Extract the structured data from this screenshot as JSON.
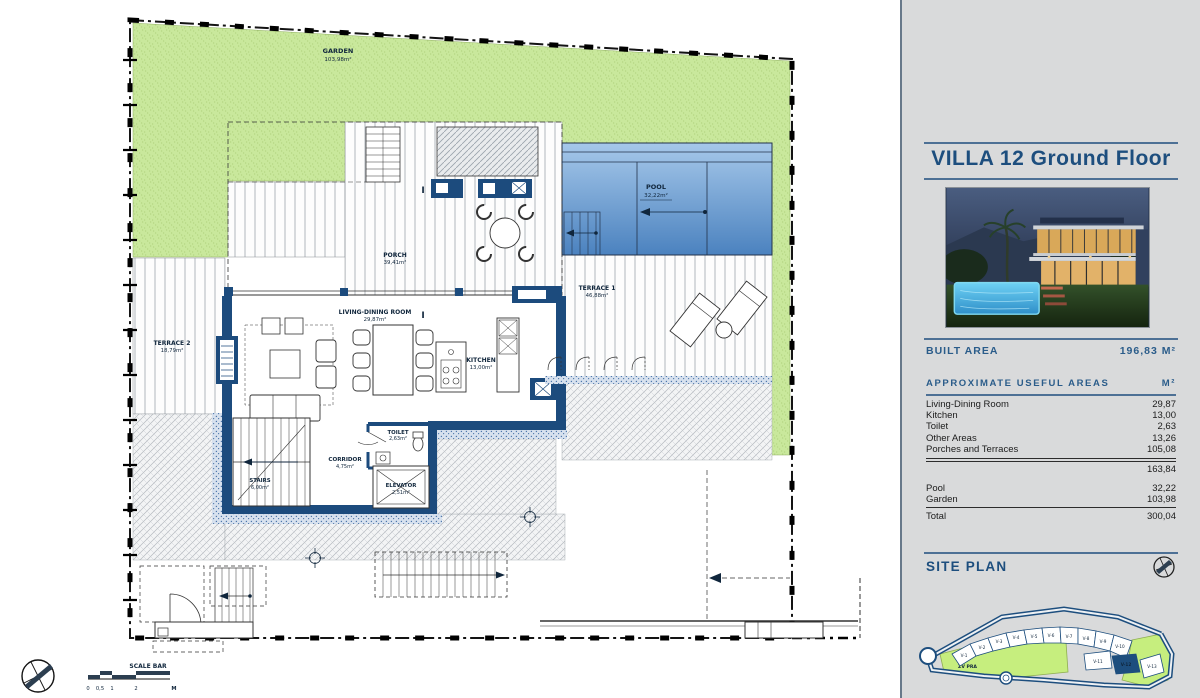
{
  "panel": {
    "title": "VILLA 12 Ground Floor",
    "built_area": {
      "label": "BUILT AREA",
      "value": "196,83 M²"
    },
    "areas": {
      "heading": "APPROXIMATE USEFUL AREAS",
      "unit": "M²",
      "rows": [
        {
          "label": "Living-Dining Room",
          "value": "29,87"
        },
        {
          "label": "Kitchen",
          "value": "13,00"
        },
        {
          "label": "Toilet",
          "value": "2,63"
        },
        {
          "label": "Other Areas",
          "value": "13,26"
        },
        {
          "label": "Porches and Terraces",
          "value": "105,08"
        }
      ],
      "subtotal": "163,84",
      "outdoor_rows": [
        {
          "label": "Pool",
          "value": "32,22"
        },
        {
          "label": "Garden",
          "value": "103,98"
        }
      ],
      "total_label": "Total",
      "total_value": "300,04"
    },
    "site_plan": {
      "heading": "SITE PLAN",
      "green_label": "ZV PRA",
      "plots": [
        "V-1",
        "V-2",
        "V-3",
        "V-4",
        "V-5",
        "V-6",
        "V-7",
        "V-8",
        "V-9",
        "V-10",
        "V-11",
        "V-12",
        "V-13"
      ],
      "highlighted_plot": "V-12"
    }
  },
  "plan": {
    "labels": {
      "garden": {
        "name": "GARDEN",
        "area": "103,98m²"
      },
      "pool": {
        "name": "POOL",
        "area": "32,22m²"
      },
      "porch": {
        "name": "PORCH",
        "area": "39,41m²"
      },
      "terrace1": {
        "name": "TERRACE 1",
        "area": "46,88m²"
      },
      "terrace2": {
        "name": "TERRACE 2",
        "area": "18,79m²"
      },
      "living": {
        "name": "LIVING-DINING ROOM",
        "area": "29,87m²"
      },
      "kitchen": {
        "name": "KITCHEN",
        "area": "13,00m²"
      },
      "toilet": {
        "name": "TOILET",
        "area": "2,63m²"
      },
      "corridor": {
        "name": "CORRIDOR",
        "area": "4,75m²"
      },
      "stairs": {
        "name": "STAIRS",
        "area": "6,00m²"
      },
      "elevator": {
        "name": "ELEVATOR",
        "area": "2,51m²"
      }
    },
    "section_mark": "I",
    "scale_bar": {
      "label": "SCALE BAR",
      "ticks": [
        "0",
        "0,5",
        "1",
        "2"
      ],
      "unit": "M"
    }
  },
  "colors": {
    "accent_blue": "#1d4e7e",
    "wall_navy": "#1c4b7d",
    "garden_green": "#c9e89c",
    "pool_blue": "#4b82bf",
    "panel_bg": "#d9dadb"
  }
}
